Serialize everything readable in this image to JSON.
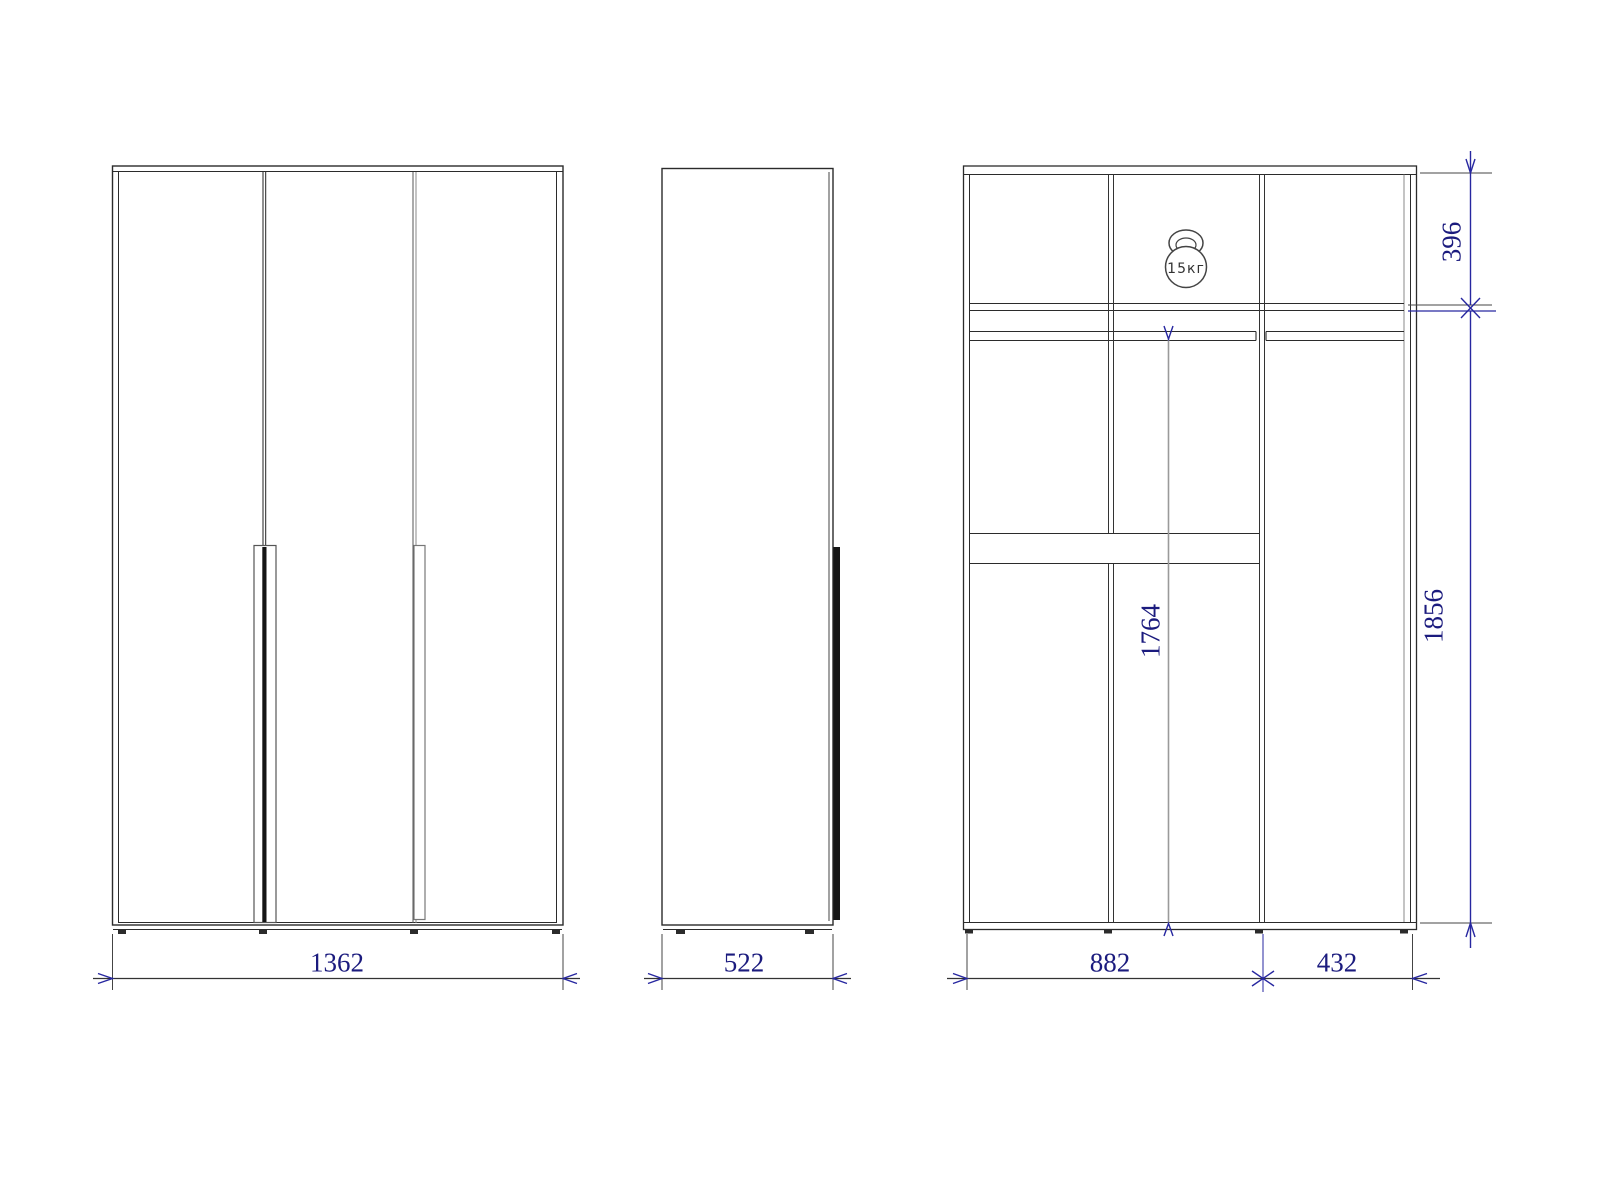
{
  "drawing": {
    "type": "wardrobe-technical-drawing",
    "views": {
      "front": {
        "label": "front view",
        "doors": 3
      },
      "side": {
        "label": "side view"
      },
      "section": {
        "label": "internal section view",
        "bays": 3
      }
    },
    "dimensions": {
      "front_width": "1362",
      "side_depth": "522",
      "section_left_width": "882",
      "section_right_width": "432",
      "top_section_height": "396",
      "cabinet_height": "1856",
      "interior_height": "1764"
    },
    "load_badge": {
      "text": "15кг"
    },
    "colors": {
      "line": "#2b2b2b",
      "light_line": "#777777",
      "aux_line": "#9a9a9a",
      "dim_text": "#1b1b7e",
      "arrow": "#2727a0"
    }
  }
}
